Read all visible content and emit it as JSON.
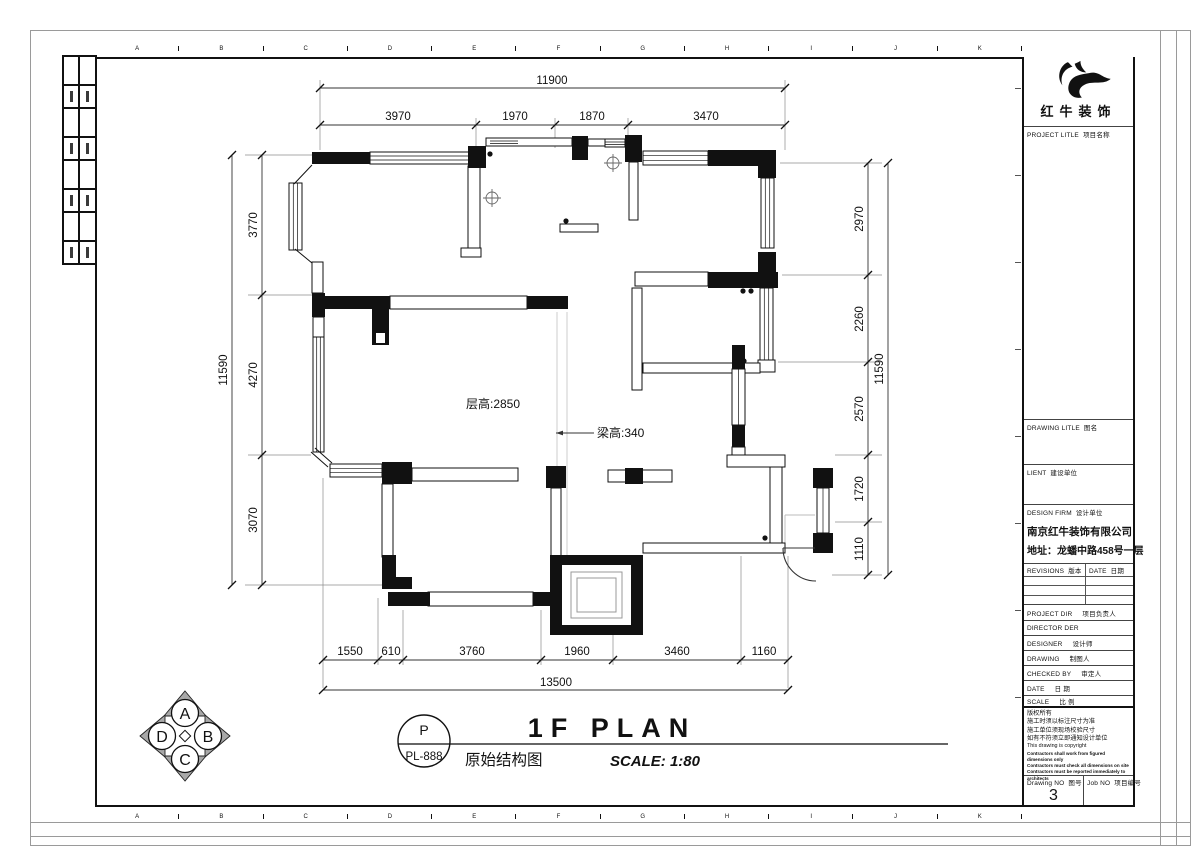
{
  "sheet": {
    "grid_letters": [
      "A",
      "B",
      "C",
      "D",
      "E",
      "F",
      "G",
      "H",
      "I",
      "J",
      "K"
    ]
  },
  "logo": {
    "name": "红牛装饰"
  },
  "title_block": {
    "project_title": {
      "en": "PROJECT LITLE",
      "zh": "项目名称"
    },
    "drawing_title": {
      "en": "DRAWING LITLE",
      "zh": "图名"
    },
    "client": {
      "en": "LIENT",
      "zh": "建设单位"
    },
    "design_firm": {
      "en": "DESIGN FIRM",
      "zh": "设计单位"
    },
    "design_firm_name": "南京红牛装饰有限公司",
    "design_firm_address": "地址：龙蟠中路458号一层",
    "revisions": {
      "en": "REVISIONS",
      "zh": "版本"
    },
    "date_col": {
      "en": "DATE",
      "zh": "日期"
    },
    "project_dir": {
      "en": "PROJECT DIR",
      "zh": "项目负责人"
    },
    "director": {
      "en": "DIRECTOR DER",
      "zh": ""
    },
    "designer": {
      "en": "DESIGNER",
      "zh": "设计师"
    },
    "drawing_by": {
      "en": "DRAWING",
      "zh": "制图人"
    },
    "checked_by": {
      "en": "CHECKED BY",
      "zh": "审定人"
    },
    "date_row": {
      "en": "DATE",
      "zh": "日 期"
    },
    "scale_row": {
      "en": "SCALE",
      "zh": "比 例"
    },
    "copyright_lines": [
      "版权所有",
      "施工时须以标注尺寸为准",
      "施工单位须现场校验尺寸",
      "如有不符须立即通知设计单位",
      "This drawing is copyright",
      "Contractors shall work from figured dimensions only",
      "Contractors must check all dimensions on site",
      "Contractors must be reported immediately to architects"
    ],
    "drawing_no": {
      "en": "Drawing NO",
      "zh": "图号",
      "value": "3"
    },
    "job_no": {
      "en": "Job NO",
      "zh": "项目编号"
    }
  },
  "plan": {
    "floor_height_label": "层高:2850",
    "beam_height_label": "梁高:340",
    "dims": {
      "top_total": "11900",
      "top": [
        "3970",
        "1970",
        "1870",
        "3470"
      ],
      "left_total": "11590",
      "left": [
        "3770",
        "4270",
        "3070"
      ],
      "right": [
        "2970",
        "2260",
        "2570",
        "1720",
        "1110"
      ],
      "right_total": "11590",
      "bottom": [
        "1550",
        "610",
        "3760",
        "1960",
        "3460",
        "1160"
      ],
      "bottom_total": "13500"
    }
  },
  "title_group": {
    "stamp_letter": "P",
    "stamp_code": "PL-888",
    "title": "1F PLAN",
    "subtitle": "原始结构图",
    "scale": "SCALE: 1:80"
  },
  "compass": {
    "top": "A",
    "right": "B",
    "bottom": "C",
    "left": "D"
  }
}
